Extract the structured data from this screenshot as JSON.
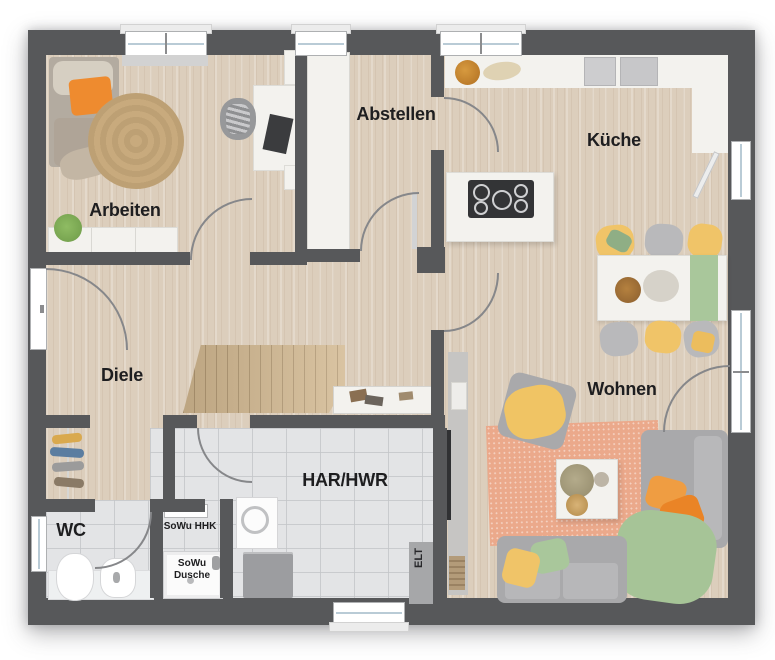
{
  "floor_plan": {
    "rooms": [
      {
        "id": "arbeiten",
        "label": "Arbeiten"
      },
      {
        "id": "abstellen",
        "label": "Abstellen"
      },
      {
        "id": "kueche",
        "label": "Küche"
      },
      {
        "id": "diele",
        "label": "Diele"
      },
      {
        "id": "wohnen",
        "label": "Wohnen"
      },
      {
        "id": "wc",
        "label": "WC"
      },
      {
        "id": "har_hwr",
        "label": "HAR/HWR"
      }
    ],
    "annotations": [
      {
        "id": "sowu_hhk",
        "label": "SoWu HHK"
      },
      {
        "id": "sowu_dusche",
        "label": "SoWu\nDusche"
      },
      {
        "id": "elt",
        "label": "ELT"
      }
    ],
    "colors": {
      "wall": "#57585a",
      "wood_floor": "#dccebc",
      "tile_floor": "#e3e4e6",
      "accent_orange": "#ee8b2f",
      "accent_yellow": "#f0c468",
      "accent_green": "#a5c297",
      "rug_salmon": "#eba98b",
      "rug_jute": "#c8aa7d",
      "furniture_white": "#f3f2ee",
      "furniture_gray": "#a9a9ab"
    }
  }
}
